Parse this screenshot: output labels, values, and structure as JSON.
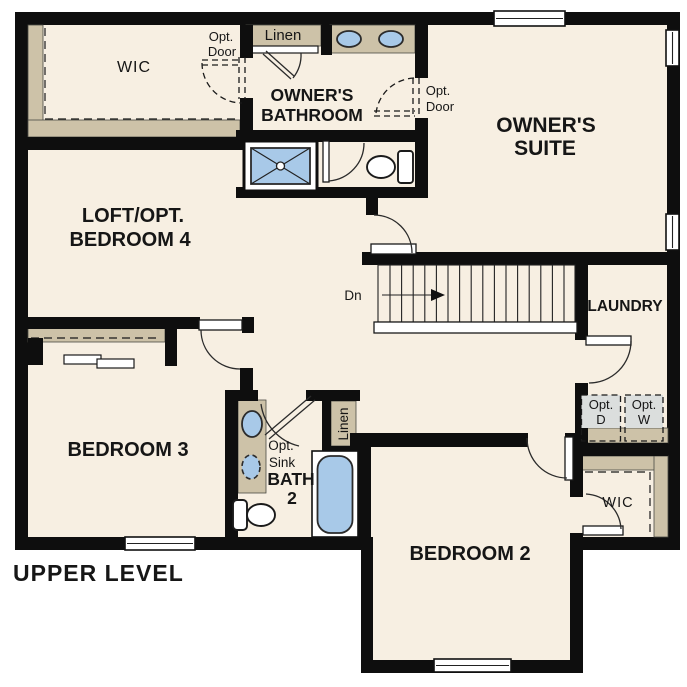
{
  "floor_plan": {
    "title": "UPPER LEVEL",
    "rooms": {
      "owner_wic": {
        "label": "WIC"
      },
      "owners_bathroom": {
        "line1": "OWNER'S",
        "line2": "BATHROOM"
      },
      "owners_suite": {
        "line1": "OWNER'S",
        "line2": "SUITE"
      },
      "loft": {
        "line1": "LOFT/OPT.",
        "line2": "BEDROOM 4"
      },
      "laundry": {
        "label": "LAUNDRY"
      },
      "bedroom3": {
        "label": "BEDROOM 3"
      },
      "bath2": {
        "line1": "BATH",
        "line2": "2"
      },
      "bedroom2": {
        "label": "BEDROOM 2"
      },
      "bedroom2_wic": {
        "label": "WIC"
      }
    },
    "features": {
      "linen_upper": {
        "label": "Linen"
      },
      "linen_bath2": {
        "label": "Linen"
      },
      "opt_door_wic": {
        "line1": "Opt.",
        "line2": "Door"
      },
      "opt_door_suite": {
        "line1": "Opt.",
        "line2": "Door"
      },
      "opt_sink": {
        "line1": "Opt.",
        "line2": "Sink"
      },
      "opt_dryer": {
        "line1": "Opt.",
        "line2": "D"
      },
      "opt_washer": {
        "line1": "Opt.",
        "line2": "W"
      },
      "stairs_direction": {
        "label": "Dn"
      }
    },
    "colors": {
      "wall": "#0e0e0e",
      "floor": "#f7efe2",
      "shelf_tan": "#cdc2a8",
      "fixture_blue": "#a8c9e8",
      "appliance_gray": "#dbdedd",
      "background": "#ffffff"
    }
  }
}
